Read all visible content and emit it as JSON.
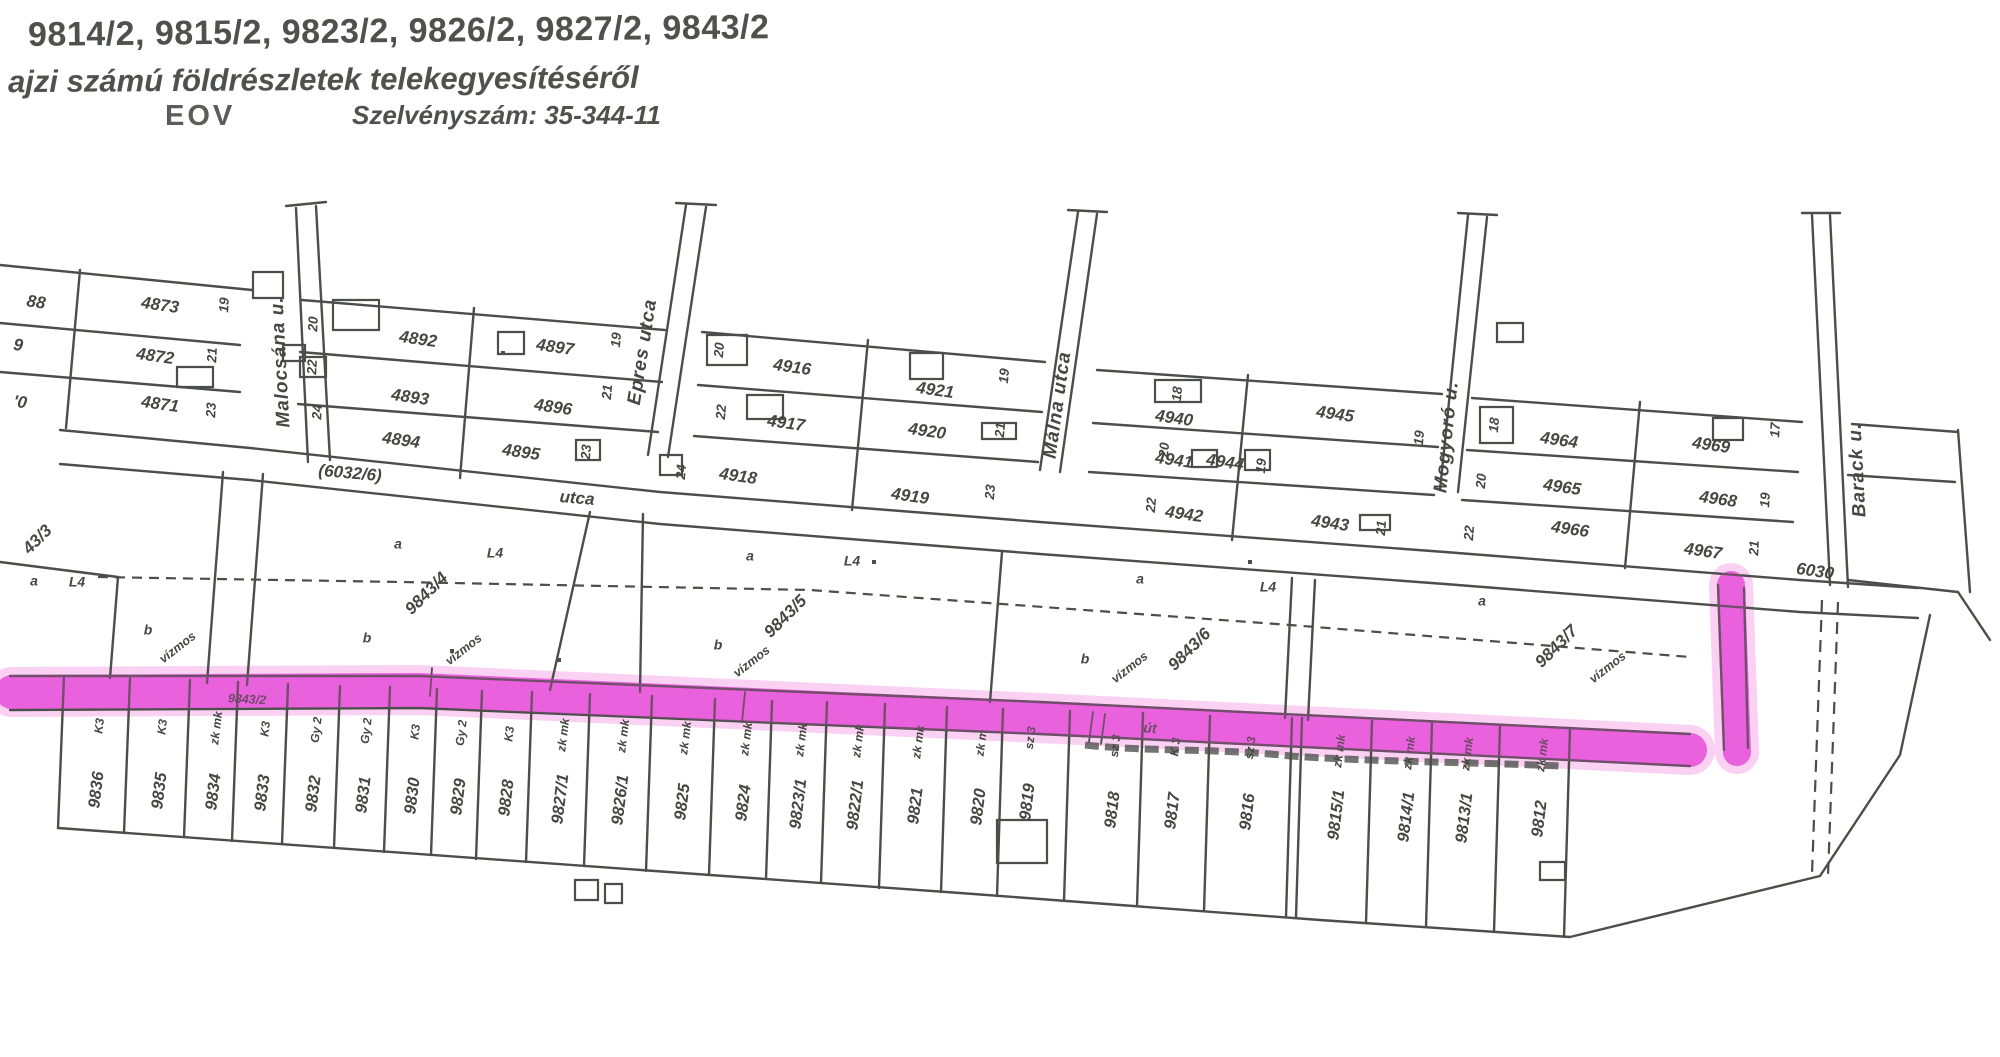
{
  "header": {
    "parcel_list_line": "9814/2, 9815/2, 9823/2, 9826/2, 9827/2, 9843/2",
    "subject_line": "ajzi számú földrészletek telekegyesítéséről",
    "projection": "EOV",
    "sheet_number": "Szelvényszám: 35-344-11"
  },
  "colors": {
    "ink": "#4b4e49",
    "highlight": "#e84fd9",
    "highlight_glow": "#f5a9ea"
  },
  "map": {
    "labels": [
      {
        "t": "4873",
        "x": 160,
        "y": 306,
        "r": 8
      },
      {
        "t": "4872",
        "x": 155,
        "y": 357,
        "r": 8
      },
      {
        "t": "4871",
        "x": 160,
        "y": 405,
        "r": 8
      },
      {
        "t": "88",
        "x": 36,
        "y": 303,
        "r": 8
      },
      {
        "t": "9",
        "x": 18,
        "y": 346,
        "r": 8
      },
      {
        "t": "'0",
        "x": 20,
        "y": 403,
        "r": 8
      },
      {
        "t": "19",
        "x": 225,
        "y": 305,
        "r": -87,
        "c": "h"
      },
      {
        "t": "21",
        "x": 213,
        "y": 355,
        "r": -87,
        "c": "h"
      },
      {
        "t": "23",
        "x": 212,
        "y": 410,
        "r": -87,
        "c": "h"
      },
      {
        "t": "4892",
        "x": 418,
        "y": 340,
        "r": 8
      },
      {
        "t": "4893",
        "x": 410,
        "y": 398,
        "r": 8
      },
      {
        "t": "4894",
        "x": 401,
        "y": 441,
        "r": 8
      },
      {
        "t": "4897",
        "x": 555,
        "y": 348,
        "r": 8
      },
      {
        "t": "4896",
        "x": 553,
        "y": 408,
        "r": 8
      },
      {
        "t": "4895",
        "x": 521,
        "y": 453,
        "r": 8
      },
      {
        "t": "20",
        "x": 314,
        "y": 324,
        "r": -87,
        "c": "h"
      },
      {
        "t": "22",
        "x": 313,
        "y": 367,
        "r": -87,
        "c": "h"
      },
      {
        "t": "24",
        "x": 318,
        "y": 412,
        "r": -87,
        "c": "h"
      },
      {
        "t": "19",
        "x": 617,
        "y": 340,
        "r": -85,
        "c": "h"
      },
      {
        "t": "21",
        "x": 608,
        "y": 392,
        "r": -85,
        "c": "h"
      },
      {
        "t": "23",
        "x": 587,
        "y": 452,
        "r": -85,
        "c": "h"
      },
      {
        "t": "(6032/6)",
        "x": 350,
        "y": 474,
        "r": 5
      },
      {
        "t": "utca",
        "x": 577,
        "y": 499,
        "r": 5
      },
      {
        "t": "4916",
        "x": 792,
        "y": 368,
        "r": 8
      },
      {
        "t": "4921",
        "x": 935,
        "y": 391,
        "r": 8
      },
      {
        "t": "4917",
        "x": 786,
        "y": 424,
        "r": 8
      },
      {
        "t": "4920",
        "x": 927,
        "y": 432,
        "r": 8
      },
      {
        "t": "4918",
        "x": 738,
        "y": 477,
        "r": 8
      },
      {
        "t": "4919",
        "x": 910,
        "y": 497,
        "r": 8
      },
      {
        "t": "20",
        "x": 720,
        "y": 350,
        "r": -85,
        "c": "h"
      },
      {
        "t": "22",
        "x": 722,
        "y": 412,
        "r": -85,
        "c": "h"
      },
      {
        "t": "24",
        "x": 682,
        "y": 472,
        "r": -85,
        "c": "h"
      },
      {
        "t": "19",
        "x": 1005,
        "y": 376,
        "r": -85,
        "c": "h"
      },
      {
        "t": "21",
        "x": 1001,
        "y": 430,
        "r": -85,
        "c": "h"
      },
      {
        "t": "23",
        "x": 991,
        "y": 492,
        "r": -85,
        "c": "h"
      },
      {
        "t": "4940",
        "x": 1174,
        "y": 419,
        "r": 8
      },
      {
        "t": "4945",
        "x": 1335,
        "y": 415,
        "r": 8
      },
      {
        "t": "4941",
        "x": 1174,
        "y": 461,
        "r": 8
      },
      {
        "t": "4944",
        "x": 1225,
        "y": 463,
        "r": 8
      },
      {
        "t": "4942",
        "x": 1184,
        "y": 515,
        "r": 8
      },
      {
        "t": "4943",
        "x": 1330,
        "y": 524,
        "r": 8
      },
      {
        "t": "18",
        "x": 1178,
        "y": 394,
        "r": -85,
        "c": "h"
      },
      {
        "t": "20",
        "x": 1165,
        "y": 450,
        "r": -85,
        "c": "h"
      },
      {
        "t": "22",
        "x": 1152,
        "y": 505,
        "r": -85,
        "c": "h"
      },
      {
        "t": "19",
        "x": 1262,
        "y": 466,
        "r": -85,
        "c": "h"
      },
      {
        "t": "21",
        "x": 1382,
        "y": 528,
        "r": -85,
        "c": "h"
      },
      {
        "t": "4964",
        "x": 1559,
        "y": 441,
        "r": 8
      },
      {
        "t": "4965",
        "x": 1562,
        "y": 488,
        "r": 8
      },
      {
        "t": "4966",
        "x": 1570,
        "y": 530,
        "r": 8
      },
      {
        "t": "4969",
        "x": 1711,
        "y": 446,
        "r": 8
      },
      {
        "t": "4968",
        "x": 1718,
        "y": 500,
        "r": 8
      },
      {
        "t": "4967",
        "x": 1703,
        "y": 552,
        "r": 8
      },
      {
        "t": "18",
        "x": 1495,
        "y": 425,
        "r": -85,
        "c": "h"
      },
      {
        "t": "20",
        "x": 1482,
        "y": 481,
        "r": -85,
        "c": "h"
      },
      {
        "t": "22",
        "x": 1470,
        "y": 533,
        "r": -85,
        "c": "h"
      },
      {
        "t": "17",
        "x": 1776,
        "y": 430,
        "r": -87,
        "c": "h"
      },
      {
        "t": "19",
        "x": 1766,
        "y": 500,
        "r": -87,
        "c": "h"
      },
      {
        "t": "21",
        "x": 1755,
        "y": 548,
        "r": -87,
        "c": "h"
      },
      {
        "t": "19",
        "x": 1420,
        "y": 438,
        "r": -85,
        "c": "h"
      },
      {
        "t": "Malocsána u.",
        "x": 281,
        "y": 362,
        "r": -93,
        "c": "s"
      },
      {
        "t": "Epres utca",
        "x": 643,
        "y": 352,
        "r": -81,
        "c": "s"
      },
      {
        "t": "Málna utca",
        "x": 1058,
        "y": 405,
        "r": -82,
        "c": "s"
      },
      {
        "t": "Mogyoró u.",
        "x": 1447,
        "y": 437,
        "r": -84,
        "c": "s"
      },
      {
        "t": "Barack u.",
        "x": 1858,
        "y": 470,
        "r": -93,
        "c": "s"
      },
      {
        "t": "6030",
        "x": 1815,
        "y": 572,
        "r": 8
      },
      {
        "t": "43/3",
        "x": 38,
        "y": 540,
        "r": -45
      },
      {
        "t": "a",
        "x": 34,
        "y": 582,
        "r": 0,
        "c": "m"
      },
      {
        "t": "L4",
        "x": 77,
        "y": 583,
        "r": 0,
        "c": "m"
      },
      {
        "t": "b",
        "x": 148,
        "y": 631,
        "r": 0,
        "c": "m"
      },
      {
        "t": "vízmos",
        "x": 178,
        "y": 648,
        "r": -38,
        "c": "t"
      },
      {
        "t": "9843/4",
        "x": 427,
        "y": 594,
        "r": -45
      },
      {
        "t": "a",
        "x": 398,
        "y": 545,
        "r": 0,
        "c": "m"
      },
      {
        "t": "L4",
        "x": 495,
        "y": 554,
        "r": 0,
        "c": "m"
      },
      {
        "t": "b",
        "x": 367,
        "y": 639,
        "r": 0,
        "c": "m"
      },
      {
        "t": "vízmos",
        "x": 464,
        "y": 650,
        "r": -38,
        "c": "t"
      },
      {
        "t": "9843/5",
        "x": 786,
        "y": 617,
        "r": -45
      },
      {
        "t": "a",
        "x": 750,
        "y": 557,
        "r": 0,
        "c": "m"
      },
      {
        "t": "L4",
        "x": 852,
        "y": 562,
        "r": 0,
        "c": "m"
      },
      {
        "t": "b",
        "x": 718,
        "y": 646,
        "r": 0,
        "c": "m"
      },
      {
        "t": "vízmos",
        "x": 752,
        "y": 662,
        "r": -38,
        "c": "t"
      },
      {
        "t": "9843/6",
        "x": 1190,
        "y": 650,
        "r": -45
      },
      {
        "t": "a",
        "x": 1140,
        "y": 580,
        "r": 0,
        "c": "m"
      },
      {
        "t": "L4",
        "x": 1268,
        "y": 588,
        "r": 0,
        "c": "m"
      },
      {
        "t": "b",
        "x": 1085,
        "y": 660,
        "r": 0,
        "c": "m"
      },
      {
        "t": "vízmos",
        "x": 1130,
        "y": 668,
        "r": -38,
        "c": "t"
      },
      {
        "t": "9843/7",
        "x": 1557,
        "y": 647,
        "r": -45
      },
      {
        "t": "a",
        "x": 1482,
        "y": 602,
        "r": 0,
        "c": "m"
      },
      {
        "t": "vízmos",
        "x": 1608,
        "y": 668,
        "r": -38,
        "c": "t"
      },
      {
        "t": "9843/2",
        "x": 247,
        "y": 700,
        "r": 3,
        "c": "t"
      },
      {
        "t": "út",
        "x": 1150,
        "y": 729,
        "r": 4,
        "c": "m"
      }
    ],
    "bottom_parcels": [
      {
        "id": "9836",
        "ann": "K3",
        "x": 97,
        "y": 790
      },
      {
        "id": "9835",
        "ann": "K3",
        "x": 160,
        "y": 791
      },
      {
        "id": "9834",
        "ann": "zk mk",
        "x": 214,
        "y": 792
      },
      {
        "id": "9833",
        "ann": "K3",
        "x": 263,
        "y": 793
      },
      {
        "id": "9832",
        "ann": "Gy 2",
        "x": 314,
        "y": 794
      },
      {
        "id": "9831",
        "ann": "Gy 2",
        "x": 364,
        "y": 795
      },
      {
        "id": "9830",
        "ann": "K3",
        "x": 413,
        "y": 796
      },
      {
        "id": "9829",
        "ann": "Gy 2",
        "x": 459,
        "y": 797
      },
      {
        "id": "9828",
        "ann": "K3",
        "x": 507,
        "y": 798
      },
      {
        "id": "9827/1",
        "ann": "zk mk",
        "x": 561,
        "y": 799
      },
      {
        "id": "9826/1",
        "ann": "zk mk",
        "x": 621,
        "y": 800
      },
      {
        "id": "9825",
        "ann": "zk mk",
        "x": 683,
        "y": 802
      },
      {
        "id": "9824",
        "ann": "zk mk",
        "x": 744,
        "y": 803
      },
      {
        "id": "9823/1",
        "ann": "zk mk",
        "x": 799,
        "y": 804
      },
      {
        "id": "9822/1",
        "ann": "zk mk",
        "x": 856,
        "y": 805
      },
      {
        "id": "9821",
        "ann": "zk mk",
        "x": 916,
        "y": 806
      },
      {
        "id": "9820",
        "ann": "zk m",
        "x": 979,
        "y": 807
      },
      {
        "id": "9819",
        "ann": "sz 3",
        "x": 1028,
        "y": 802
      },
      {
        "id": "9818",
        "ann": "sz 3",
        "x": 1113,
        "y": 810
      },
      {
        "id": "9817",
        "ann": "K 3",
        "x": 1173,
        "y": 811
      },
      {
        "id": "9816",
        "ann": "sz 3",
        "x": 1248,
        "y": 812
      },
      {
        "id": "9815/1",
        "ann": "zk mk",
        "x": 1337,
        "y": 815
      },
      {
        "id": "9814/1",
        "ann": "zk mk",
        "x": 1407,
        "y": 817
      },
      {
        "id": "9813/1",
        "ann": "zk mk",
        "x": 1465,
        "y": 818
      },
      {
        "id": "9812",
        "ann": "zk mk",
        "x": 1540,
        "y": 819
      }
    ]
  }
}
